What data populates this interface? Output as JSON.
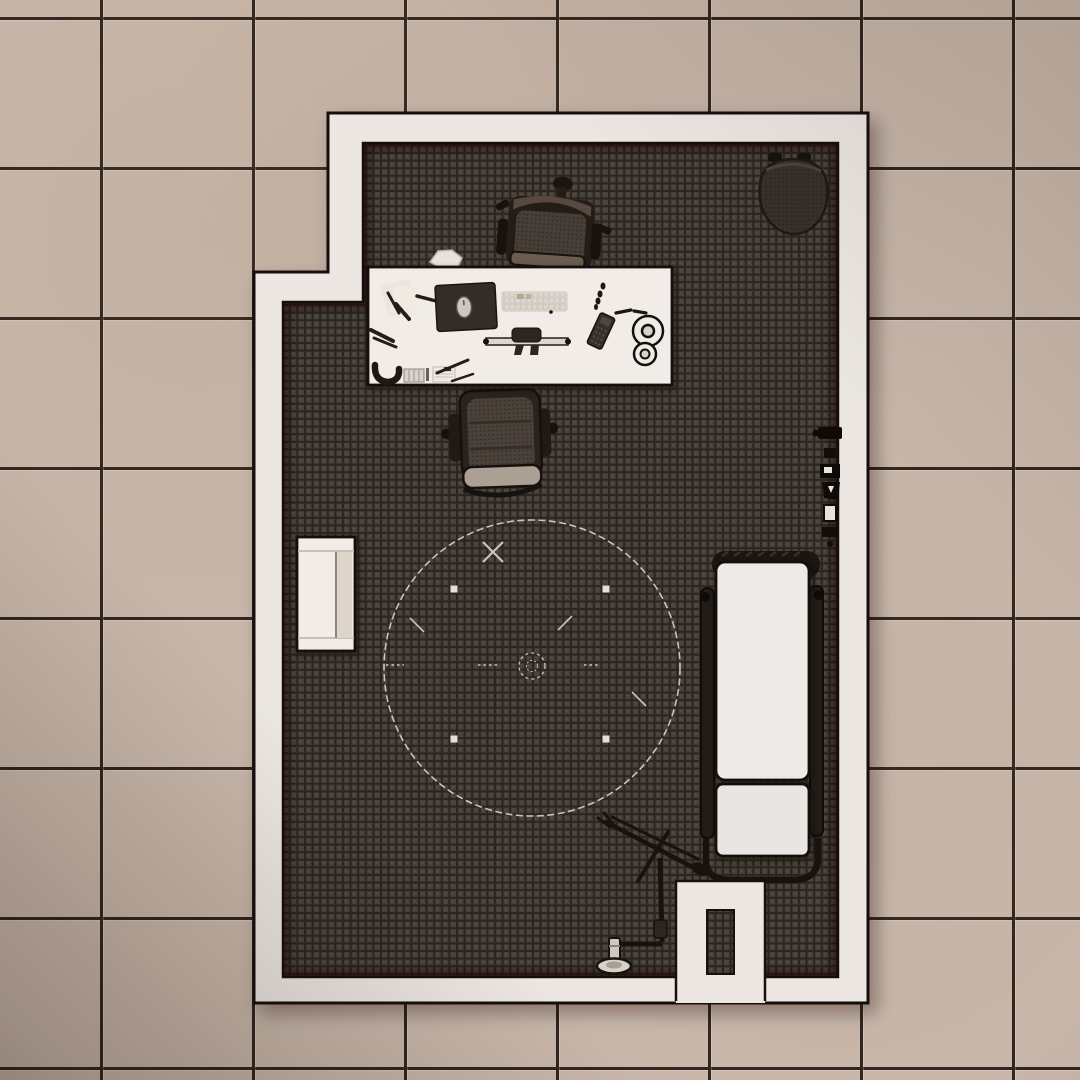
{
  "scene": {
    "title": "Top-down render of an office / examination room",
    "floor_outside": "beige ceramic tile floor with dark grout",
    "floor_inside": "dark patterned carpet",
    "wall_color_note": "white walls drawn as thick light band with dark outline"
  },
  "colors": {
    "tile": "#c9b8ab",
    "grout": "#2e241d",
    "wall": "#ece7e3",
    "outline": "#16110c",
    "carpet": "#48403a",
    "carpetline": "#2b241f",
    "carpetdot": "#5c534c",
    "chalk": "#d8cfc5",
    "white": "#f1ece8",
    "dark": "#1c1611",
    "metal": "#cfc8c0"
  },
  "objects": {
    "room": "L-shaped room with white walls and dark carpet",
    "doorway": "entry vestibule with door opening in bottom wall",
    "desk": "white office desk with scattered stationery",
    "desk_chair": "office swivel chair behind desk",
    "visitor_chair": "visitor chair in front of desk",
    "corner_chair": "round dark armchair in top-right corner",
    "cabinet": "small white cabinet on left wall",
    "bed": "white gurney bed with side rails",
    "lamp": "articulated boom floor lamp",
    "chalk_circle": "chalk circle floor marking with tape squares",
    "mousepad": "dark desk pad with mouse",
    "keyboard": "white keyboard",
    "tape_rolls": "two white tape rolls",
    "ruler_tool": "rolling drafting ruler",
    "phone": "small dark handheld device",
    "pens": "scattered pens and pencils",
    "papers": "loose papers and note pads",
    "wall_equipment": "dark equipment along right wall",
    "crumpled_paper": "crumpled paper beside chair"
  }
}
